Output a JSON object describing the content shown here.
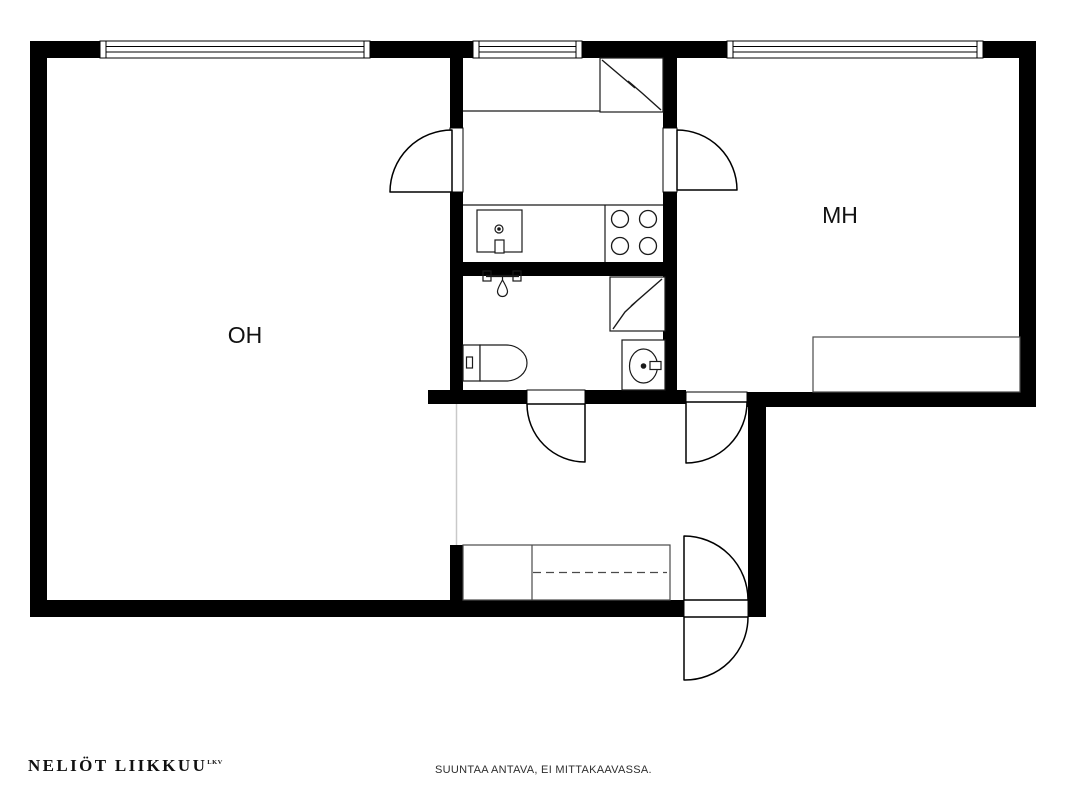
{
  "rooms": [
    {
      "id": "oh",
      "label": "OH"
    },
    {
      "id": "mh",
      "label": "MH"
    }
  ],
  "fixtures": [
    "refrigerator-icon",
    "kitchen-sink-icon",
    "stove-icon",
    "shower-icon",
    "water-heater-icon",
    "toilet-icon",
    "washbasin-icon",
    "bed-icon",
    "wardrobe-icon",
    "window-icon",
    "door-arc-icon"
  ],
  "footer": {
    "logo": "NELIÖT LIIKKUU",
    "logo_sup": "LKV",
    "disclaimer": "SUUNTAA ANTAVA, EI MITTAKAAVASSA."
  },
  "colors": {
    "wall": "#000000",
    "line": "#1a1a1a",
    "furniture_line": "#4a4a4a",
    "open-boundary_line": "#c9c9c9",
    "background": "#ffffff"
  }
}
